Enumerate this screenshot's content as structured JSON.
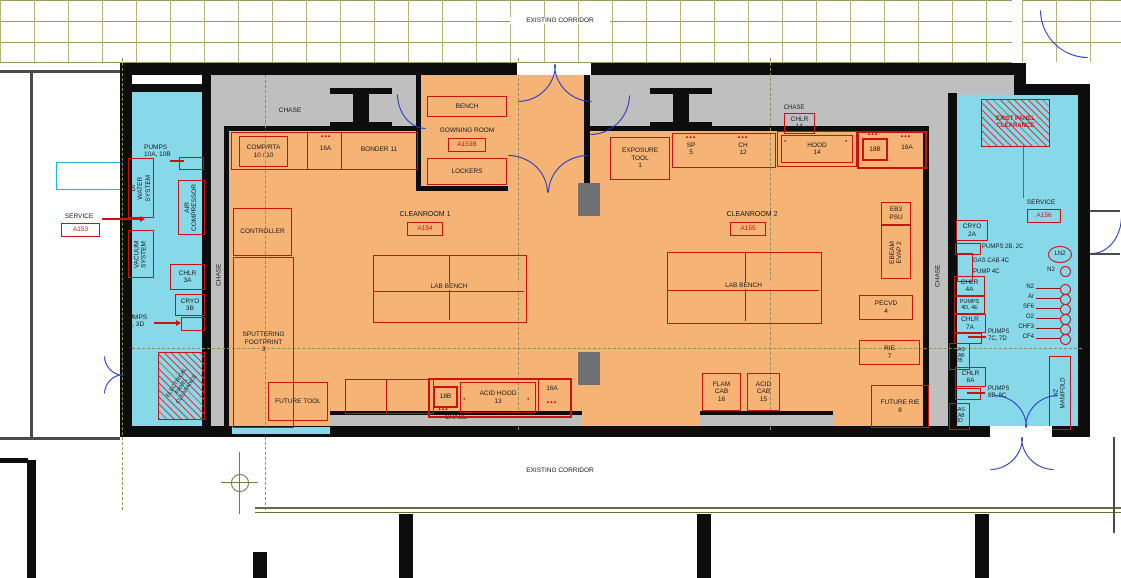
{
  "corridors": {
    "top": "EXISTING CORRIDOR",
    "bottom": "EXISTING CORRIDOR"
  },
  "chase_labels": {
    "top_left": "CHASE",
    "top_right": "CHASE",
    "left": "CHASE",
    "right": "CHASE",
    "bottom": "CHASE"
  },
  "left_service": {
    "pumps_10_label": "PUMPS\n10A, 10B",
    "di_water": "DI WATER\nSYSTEM",
    "air_compressor": "AIR\nCOMPRESSOR",
    "service_label": "SERVICE",
    "service_tag": "A153",
    "vacuum": "VACUUM\nSYSTEM",
    "chlr_3a": "CHLR\n3A",
    "cryo_3b": "CRYO\n3B",
    "pumps_3_label": "PUMPS\n3C, 3D",
    "electrical_panel": "ELECTRICAL\nPANEL\nCLEARANCE"
  },
  "gowning": {
    "bench": "BENCH",
    "label": "GOWNING ROOM",
    "tag": "A153B",
    "lockers": "LOCKERS"
  },
  "cleanroom1": {
    "name": "CLEANROOM 1",
    "tag": "A154",
    "comp_rta": "COMP/RTA\n10 / 10",
    "vent_16a_top": "16A",
    "bonder": "BONDER 11",
    "controller": "CONTROLLER",
    "sputtering": "SPUTTERING\nFOOTPRINT\n3",
    "lab_bench": "LAB BENCH",
    "future_tool": "FUTURE TOOL",
    "vent_18b": "18B",
    "acid_hood": "ACID HOOD\n13",
    "vent_16a_south": "16A"
  },
  "cleanroom2": {
    "name": "CLEANROOM 2",
    "tag": "A155",
    "chlr_1a": "CHLR\n1A",
    "exposure_tool": "EXPOSURE\nTOOL\n1",
    "sp": "SP\n5",
    "ch": "CH\n12",
    "hood": "HOOD\n14",
    "vent_18b": "18B",
    "vent_16a": "16A",
    "lab_bench": "LAB BENCH",
    "eb3_psu": "EB3\nPSU",
    "ebeam_evap": "EBEAM\nEVAP 2",
    "pecvd": "PECVD\n4",
    "rie": "RIE\n7",
    "flam_cab": "FLAM\nCAB\n16",
    "acid_cab": "ACID\nCAB\n15",
    "future_rie": "FUTURE RIE\n8"
  },
  "right_service": {
    "exist_panel": "EXIST PANEL\nCLEARANCE",
    "service_label": "SERVICE",
    "service_tag": "A156",
    "cryo_2a": "CRYO\n2A",
    "pumps_2": "PUMPS 2B, 2C",
    "gas_cab_4c": "GAS CAB 4C",
    "pump_4c": "PUMP 4C",
    "ln2": "LN2",
    "n2": "N2",
    "chlr_4a": "CHLR\n4A",
    "pumps_4": "PUMPS\n4D, 4E",
    "chlr_7a": "CHLR\n7A",
    "pumps_7": "PUMPS\n7C, 7D",
    "gases": [
      "N2",
      "Ar",
      "SF6",
      "O2",
      "CHF3",
      "CF4"
    ],
    "gas_cab_7b": "GAS\nCAB\n7B",
    "chlr_8a": "CHLR\n8A",
    "pumps_8": "PUMPS\n8B, 8C",
    "gas_cab_8d": "GAS\nCAB\n8D",
    "n2_manifold": "N2 MANIFOLD"
  },
  "marks": {
    "ticks": "▴▴▴",
    "dot": "●"
  },
  "colors": {
    "cleanroom_orange": "#f5b376",
    "service_cyan": "#87d9ea",
    "chase_gray": "#bfbfbf",
    "wall_black": "#0d0d0d",
    "equipment_red": "#cc1111",
    "door_blue": "#2336c9",
    "grid_olive": "#99995f"
  }
}
